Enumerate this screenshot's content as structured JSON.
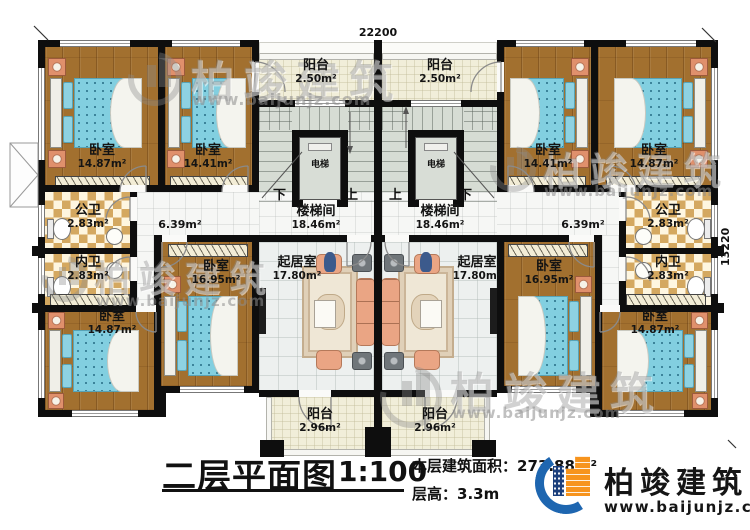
{
  "dimensions": {
    "width": "22200",
    "depth": "13220"
  },
  "unit_left": {
    "bedroom_a": {
      "name": "卧室",
      "area": "14.87m²"
    },
    "bedroom_b": {
      "name": "卧室",
      "area": "14.41m²"
    },
    "balcony_top": {
      "name": "阳台",
      "area": "2.50m²"
    },
    "stairwell": {
      "name": "楼梯间",
      "area": "18.46m²"
    },
    "elevator": {
      "name": "电梯"
    },
    "public_bath": {
      "name": "公卫",
      "area": "2.83m²"
    },
    "private_bath": {
      "name": "内卫",
      "area": "2.83m²"
    },
    "hallway": {
      "area": "6.39m²"
    },
    "living_room": {
      "name": "起居室",
      "area": "17.80m²"
    },
    "bedroom_c": {
      "name": "卧室",
      "area": "16.95m²"
    },
    "bedroom_d": {
      "name": "卧室",
      "area": "14.87m²"
    },
    "balcony_bottom": {
      "name": "阳台",
      "area": "2.96m²"
    },
    "stair_down": "下",
    "stair_up": "上"
  },
  "unit_right": {
    "bedroom_a": {
      "name": "卧室",
      "area": "14.41m²"
    },
    "bedroom_b": {
      "name": "卧室",
      "area": "14.87m²"
    },
    "balcony_top": {
      "name": "阳台",
      "area": "2.50m²"
    },
    "stairwell": {
      "name": "楼梯间",
      "area": "18.46m²"
    },
    "elevator": {
      "name": "电梯"
    },
    "public_bath": {
      "name": "公卫",
      "area": "2.83m²"
    },
    "private_bath": {
      "name": "内卫",
      "area": "2.83m²"
    },
    "hallway": {
      "area": "6.39m²"
    },
    "living_room": {
      "name": "起居室",
      "area": "17.80m²"
    },
    "bedroom_c": {
      "name": "卧室",
      "area": "16.95m²"
    },
    "bedroom_d": {
      "name": "卧室",
      "area": "14.87m²"
    },
    "balcony_bottom": {
      "name": "阳台",
      "area": "2.96m²"
    },
    "stair_up": "上",
    "stair_down": "下"
  },
  "titleblock": {
    "title": "二层平面图",
    "scale": "1:100",
    "area_label": "本层建筑面积：",
    "area_value": "273.88m²",
    "height_label": "层高：",
    "height_value": "3.3m"
  },
  "brand": {
    "name": "柏竣建筑",
    "url": "www.baijunjz.com"
  },
  "watermark": {
    "name": "柏竣建筑",
    "url": "www.baijunjz.com"
  }
}
